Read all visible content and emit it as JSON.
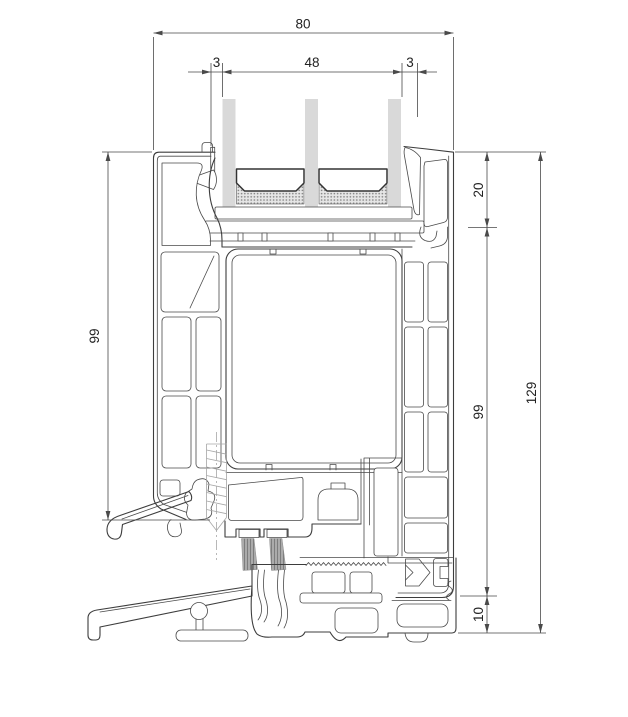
{
  "drawing": {
    "kind": "profile-cross-section",
    "dims": {
      "overall_width": {
        "value": "80"
      },
      "glass_clearance_left": {
        "value": "3"
      },
      "glazing_unit_width": {
        "value": "48"
      },
      "glass_clearance_right": {
        "value": "3"
      },
      "glazing_bead_height": {
        "value": "20"
      },
      "sash_height_left": {
        "value": "99"
      },
      "frame_height_right": {
        "value": "99"
      },
      "overall_height": {
        "value": "129"
      },
      "threshold_height": {
        "value": "10"
      }
    },
    "colors": {
      "line": "#3d3d3d",
      "dimension": "#4a4a4a",
      "glass": "#d9d9d9",
      "brush": "#9c9c9c",
      "background": "#ffffff"
    }
  }
}
